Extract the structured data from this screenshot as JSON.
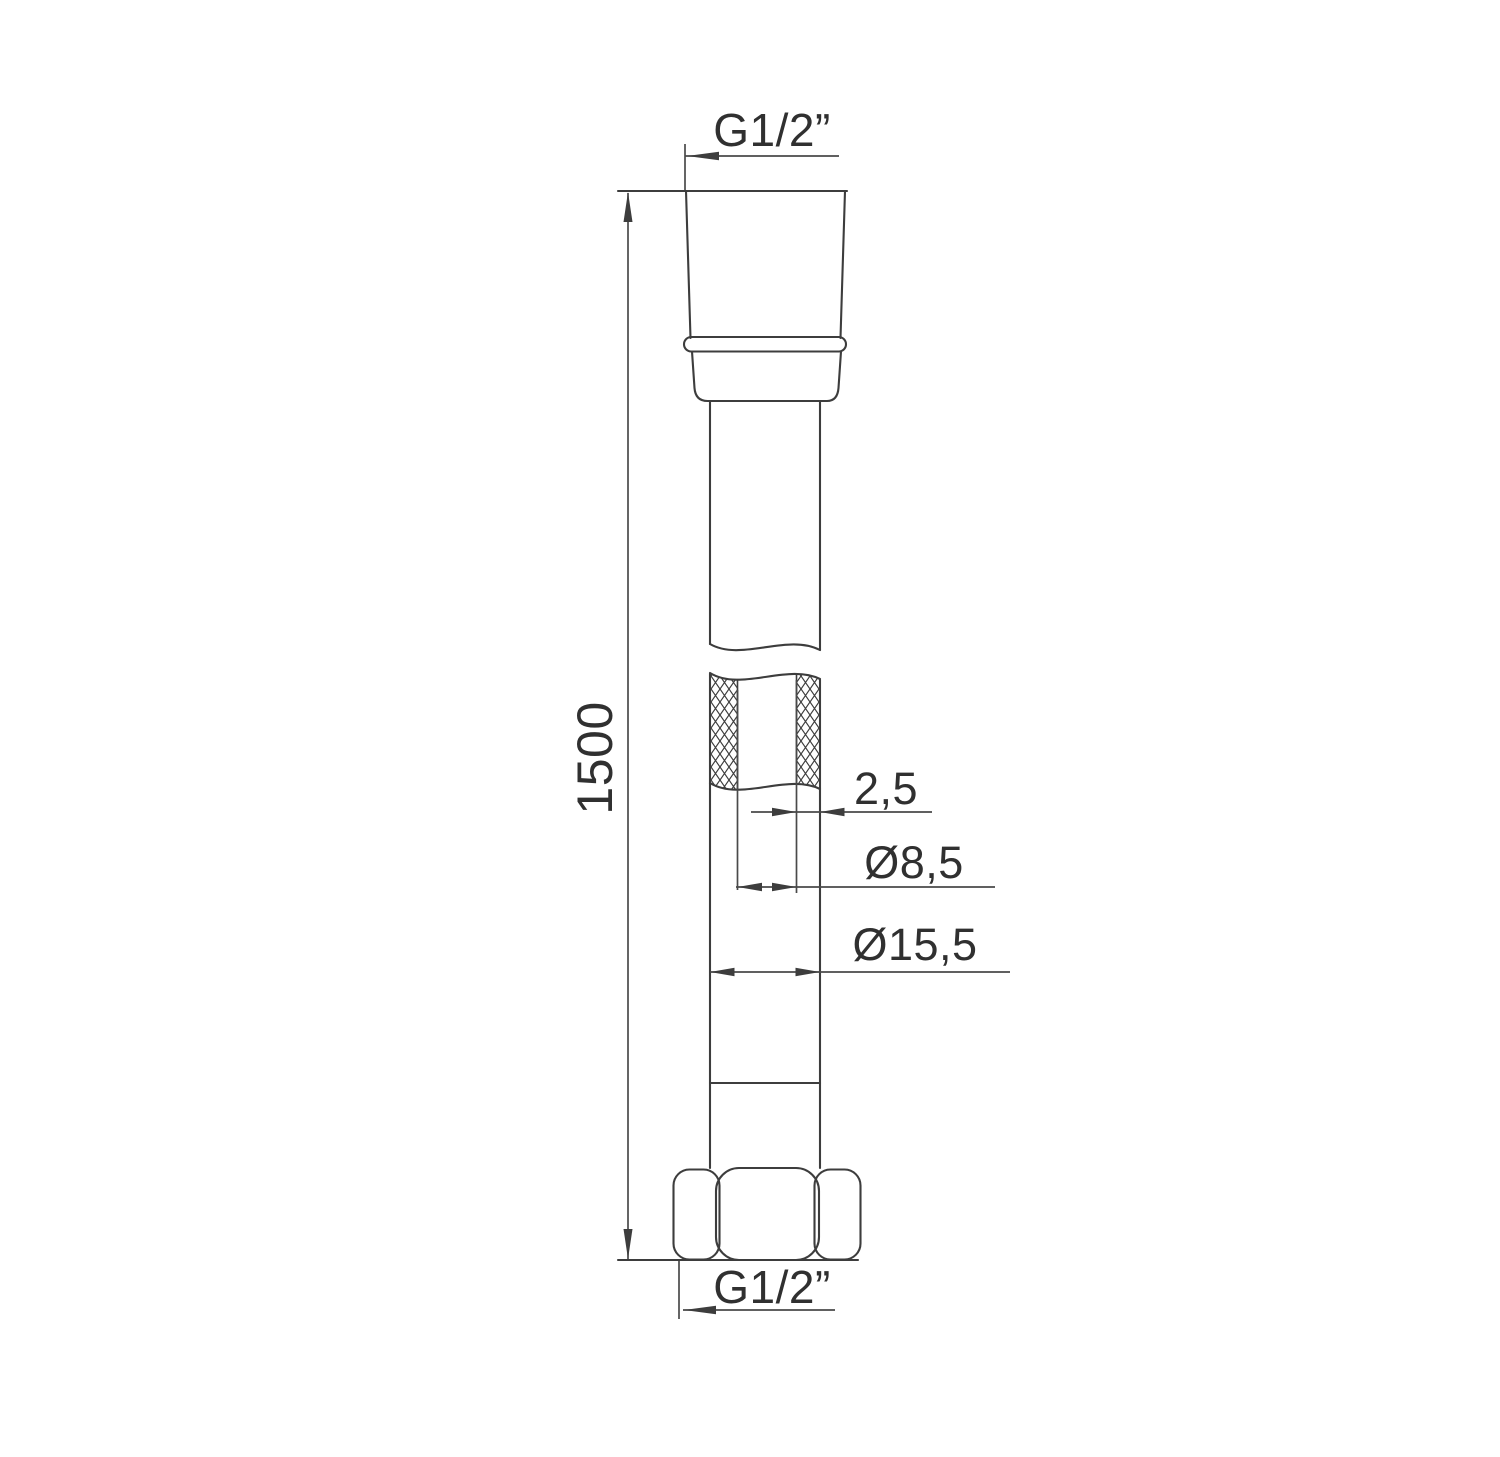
{
  "drawing": {
    "type": "technical-drawing",
    "subject": "shower-hose-side-view-with-partial-section",
    "labels": {
      "top_thread": "G1/2”",
      "length": "1500",
      "wall_thickness": "2,5",
      "inner_diameter": "Ø8,5",
      "outer_diameter": "Ø15,5",
      "bottom_thread": "G1/2”"
    },
    "colors": {
      "line": "#3d3d3d",
      "text": "#303030",
      "background": "#ffffff"
    }
  }
}
